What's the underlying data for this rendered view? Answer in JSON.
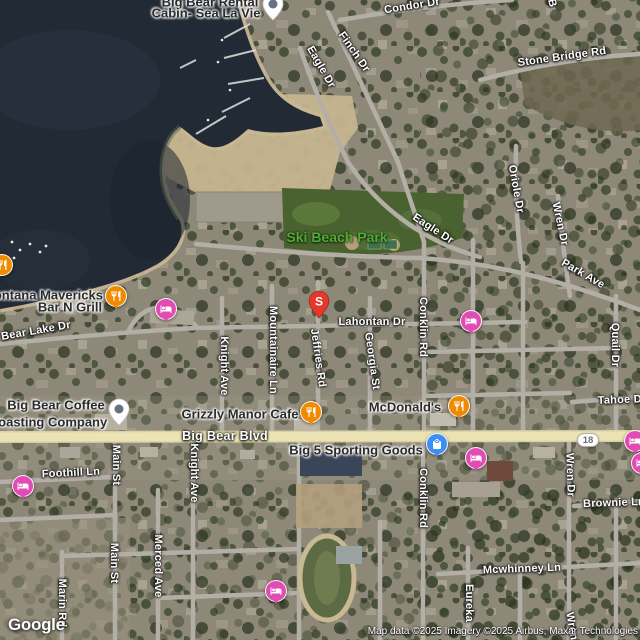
{
  "map": {
    "google_logo": "Google",
    "attribution": "Map data ©2025 Imagery ©2025 Airbus, Maxar Technologies",
    "route_shield": {
      "label": "18",
      "x": 588,
      "y": 440
    }
  },
  "colors": {
    "restaurant": "#F08B00",
    "lodging": "#E24BB4",
    "shopping": "#3D8EF5",
    "search_pin": "#E3392D",
    "place_pin_dot": "#63737F",
    "road_label": "#FFFFFF",
    "poi_label": "#2B2B2B",
    "park_label": "#4FAE2F",
    "water": "#222A35",
    "highway": "#EBE3B4"
  },
  "road_labels": [
    {
      "text": "Condor Dr",
      "x": 412,
      "y": 6,
      "rot": -9
    },
    {
      "text": "Finch Dr",
      "x": 354,
      "y": 52,
      "rot": 55
    },
    {
      "text": "Eagle Dr",
      "x": 321,
      "y": 67,
      "rot": 60
    },
    {
      "text": "B",
      "x": 552,
      "y": 3,
      "rot": 75
    },
    {
      "text": "Stone Bridge Rd",
      "x": 562,
      "y": 57,
      "rot": -8
    },
    {
      "text": "Eagle Dr",
      "x": 433,
      "y": 229,
      "rot": 33
    },
    {
      "text": "Oriole Dr",
      "x": 516,
      "y": 189,
      "rot": 80
    },
    {
      "text": "Wren Dr",
      "x": 560,
      "y": 224,
      "rot": 78
    },
    {
      "text": "Park Ave",
      "x": 583,
      "y": 274,
      "rot": 30
    },
    {
      "text": "Lahontan Dr",
      "x": 372,
      "y": 322,
      "rot": 0
    },
    {
      "text": "Bear Lake Dr",
      "x": 36,
      "y": 331,
      "rot": -10
    },
    {
      "text": "Jeffries Rd",
      "x": 318,
      "y": 358,
      "rot": 82
    },
    {
      "text": "Georgia St",
      "x": 372,
      "y": 361,
      "rot": 82
    },
    {
      "text": "Conklin Rd",
      "x": 423,
      "y": 327,
      "rot": 90
    },
    {
      "text": "Mountainaire Ln",
      "x": 273,
      "y": 350,
      "rot": 90
    },
    {
      "text": "Knight Ave",
      "x": 224,
      "y": 366,
      "rot": 90
    },
    {
      "text": "Quail Dr",
      "x": 615,
      "y": 345,
      "rot": 90
    },
    {
      "text": "Big Bear Blvd",
      "x": 225,
      "y": 436,
      "rot": 0,
      "style": "major"
    },
    {
      "text": "Main St",
      "x": 116,
      "y": 465,
      "rot": 90
    },
    {
      "text": "Knight Ave",
      "x": 194,
      "y": 473,
      "rot": 90
    },
    {
      "text": "Foothill Ln",
      "x": 71,
      "y": 473,
      "rot": -3
    },
    {
      "text": "Conklin Rd",
      "x": 423,
      "y": 498,
      "rot": 90
    },
    {
      "text": "Wren Dr",
      "x": 570,
      "y": 475,
      "rot": 88
    },
    {
      "text": "Tahoe Dr",
      "x": 622,
      "y": 400,
      "rot": -2
    },
    {
      "text": "Brownie Ln",
      "x": 614,
      "y": 503,
      "rot": -2
    },
    {
      "text": "Mcwhinney Ln",
      "x": 522,
      "y": 569,
      "rot": -2
    },
    {
      "text": "Main St",
      "x": 114,
      "y": 563,
      "rot": 90
    },
    {
      "text": "Merced Ave",
      "x": 158,
      "y": 566,
      "rot": 90
    },
    {
      "text": "Marin Rd",
      "x": 62,
      "y": 603,
      "rot": 90
    },
    {
      "text": "Eureka",
      "x": 469,
      "y": 603,
      "rot": 90
    },
    {
      "text": "Wren Dr",
      "x": 573,
      "y": 634,
      "rot": 80
    }
  ],
  "poi_labels": [
    {
      "text": "Big Bear Rental",
      "x": 210,
      "y": 2
    },
    {
      "text": "Cabin- Sea La Vie",
      "x": 206,
      "y": 13
    },
    {
      "text": "Ski Beach Park",
      "x": 337,
      "y": 237,
      "style": "park"
    },
    {
      "text": "Montana Mavericks",
      "x": 43,
      "y": 295
    },
    {
      "text": "Bar N Grill",
      "x": 70,
      "y": 307
    },
    {
      "text": "Big Bear Coffee",
      "x": 56,
      "y": 405
    },
    {
      "text": "Roasting Company",
      "x": 48,
      "y": 422
    },
    {
      "text": "Grizzly Manor Cafe",
      "x": 240,
      "y": 414
    },
    {
      "text": "McDonald's",
      "x": 405,
      "y": 407
    },
    {
      "text": "Big 5 Sporting Goods",
      "x": 356,
      "y": 450
    }
  ],
  "markers": [
    {
      "type": "place",
      "icon": "place-dot-icon",
      "shape": "teardrop",
      "x": 273,
      "y": 4
    },
    {
      "type": "restaurant",
      "icon": "restaurant-icon",
      "shape": "circle",
      "x": 2,
      "y": 265
    },
    {
      "type": "restaurant",
      "icon": "restaurant-icon",
      "shape": "pin",
      "x": 116,
      "y": 296
    },
    {
      "type": "lodging",
      "icon": "bed-icon",
      "shape": "pin",
      "x": 166,
      "y": 309
    },
    {
      "type": "search",
      "icon": "letter",
      "label": "S",
      "shape": "teardrop",
      "x": 319,
      "y": 301
    },
    {
      "type": "lodging",
      "icon": "bed-icon",
      "shape": "pin",
      "x": 471,
      "y": 321
    },
    {
      "type": "place",
      "icon": "place-dot-icon",
      "shape": "teardrop",
      "x": 119,
      "y": 409
    },
    {
      "type": "restaurant",
      "icon": "restaurant-icon",
      "shape": "pin",
      "x": 311,
      "y": 412
    },
    {
      "type": "restaurant",
      "icon": "restaurant-icon",
      "shape": "pin",
      "x": 459,
      "y": 406
    },
    {
      "type": "shopping",
      "icon": "shopping-bag-icon",
      "shape": "pin",
      "x": 437,
      "y": 444
    },
    {
      "type": "lodging",
      "icon": "bed-icon",
      "shape": "pin",
      "x": 635,
      "y": 441
    },
    {
      "type": "lodging",
      "icon": "bed-icon",
      "shape": "pin",
      "x": 476,
      "y": 458
    },
    {
      "type": "lodging",
      "icon": "bed-icon",
      "shape": "pin",
      "x": 23,
      "y": 486
    },
    {
      "type": "lodging",
      "icon": "bed-icon",
      "shape": "pin",
      "x": 642,
      "y": 463
    },
    {
      "type": "lodging",
      "icon": "bed-icon",
      "shape": "pin",
      "x": 276,
      "y": 591
    }
  ]
}
